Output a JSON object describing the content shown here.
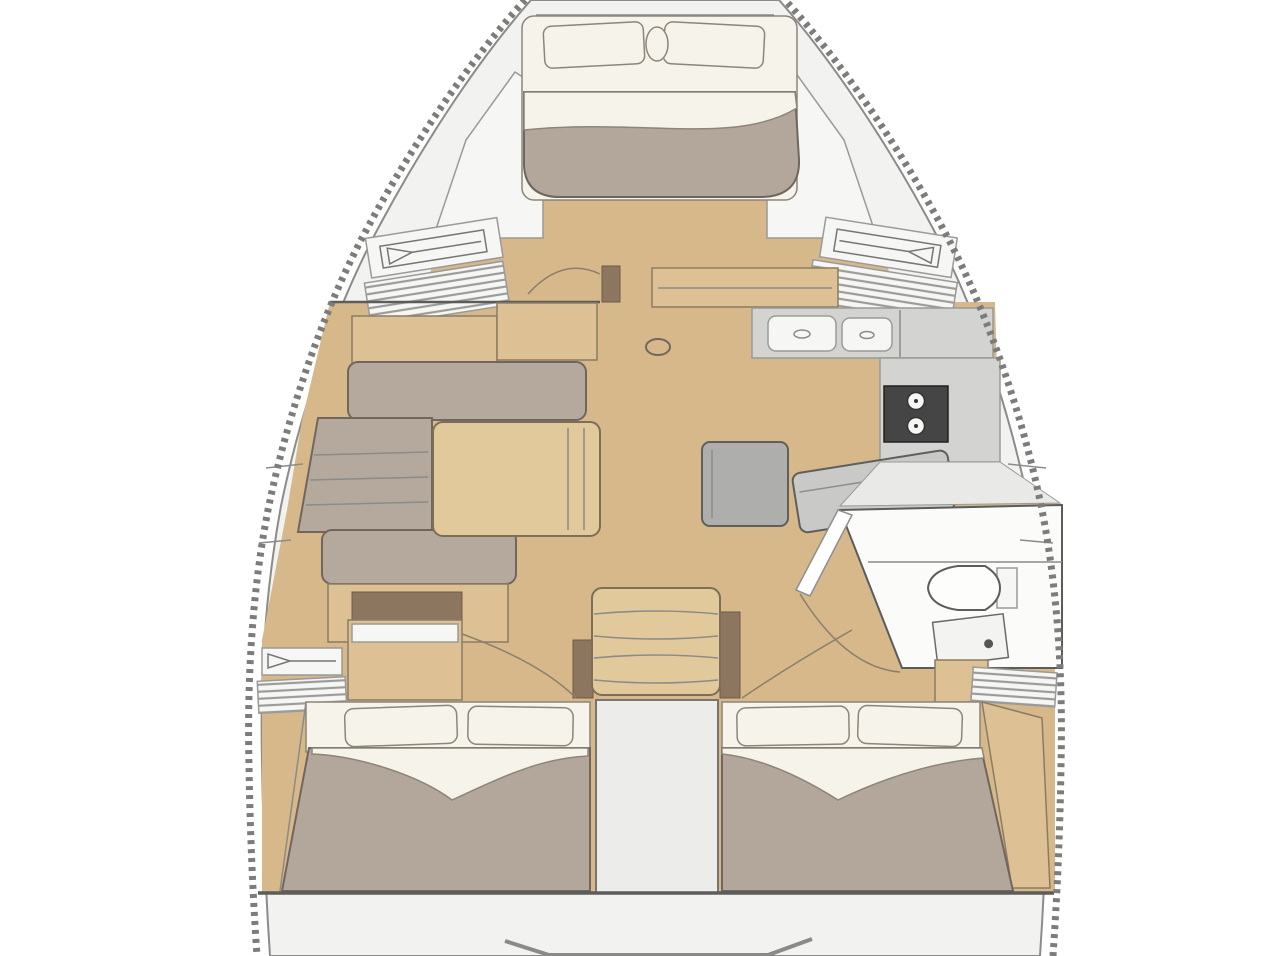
{
  "diagram": {
    "type": "sailing-yacht-interior-floor-plan",
    "orientation": "bow-at-top",
    "rooms": [
      "forward-owner-cabin",
      "saloon",
      "galley",
      "navigation-area",
      "head-with-shower",
      "companionway",
      "port-aft-cabin",
      "starboard-aft-cabin",
      "engine-compartment"
    ],
    "furniture": [
      "v-berth-double-bed",
      "l-shaped-settee",
      "saloon-table",
      "double-sink",
      "two-burner-stove",
      "nav-seat",
      "ottoman-seat",
      "toilet",
      "shower-pan",
      "companionway-steps",
      "aft-double-bed-port",
      "aft-double-bed-starboard",
      "hanging-locker-port-forward",
      "hanging-locker-starboard-forward",
      "hanging-locker-port-aft",
      "louvered-locker-starboard-aft",
      "mast-step"
    ],
    "symbols": [
      "hanging-locker-triangle-symbol",
      "louvered-vent-slats",
      "door-swing-arc",
      "dashed-hull-outline"
    ]
  },
  "palette": {
    "background": "#ffffff",
    "hull-stroke": "#7c7c7a",
    "deck": "#f2f3f1",
    "floor": "#d6b88a",
    "wood": "#ddc094",
    "wood-light": "#e2c99b",
    "wood-dark": "#8d7660",
    "upholstery": "#b5a99d",
    "blanket": "#b3a79c",
    "linen": "#f6f3ea",
    "counter": "#d3d4d1",
    "appliance": "#454545",
    "seat-gray": "#c9c9c7",
    "ottoman-gray": "#aeaeac",
    "head-floor": "#fbfbf9",
    "wall": "#5c5c5a",
    "line": "#8b8b89",
    "outline-soft": "#6f675e",
    "wood-outline": "#8a7c64"
  }
}
